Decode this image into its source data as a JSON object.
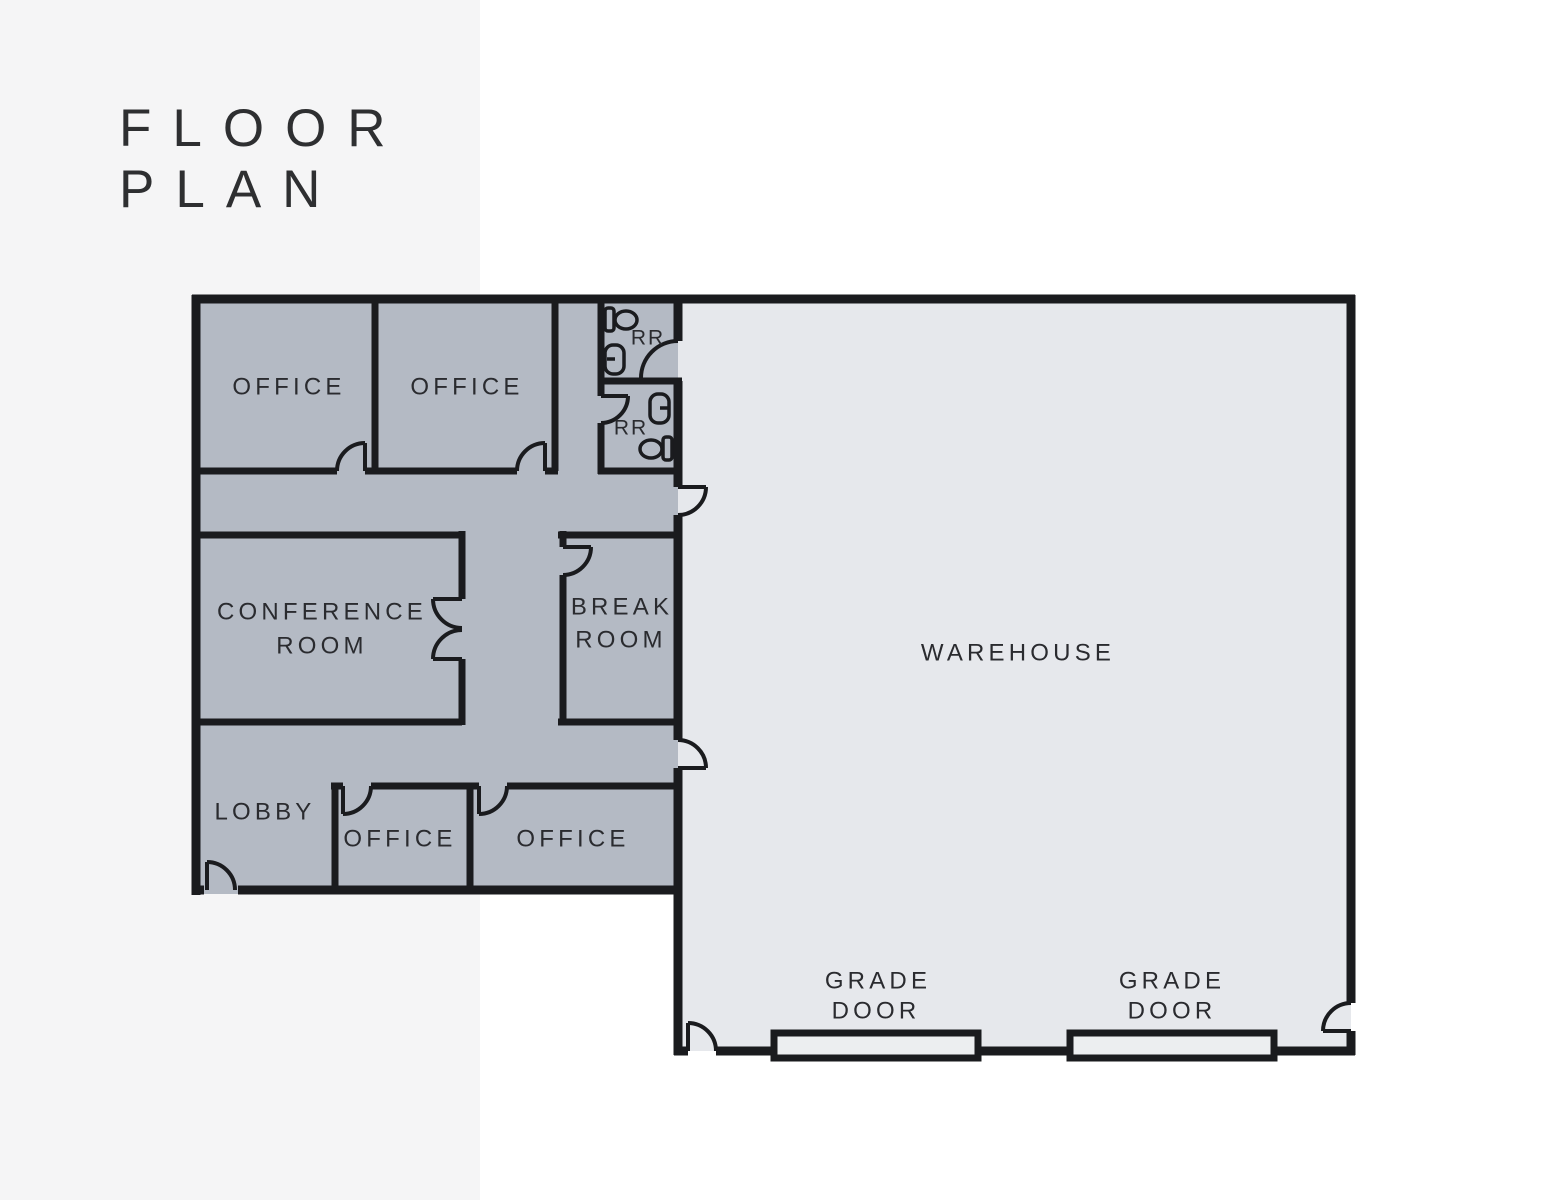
{
  "page": {
    "page_bg": "#ffffff",
    "panel_bg": "#f5f5f6",
    "title_color": "#2e2f31"
  },
  "title": {
    "line1": "FLOOR",
    "line2": "PLAN"
  },
  "plan": {
    "colors": {
      "wall": "#1a1b1e",
      "office_fill": "#b4bac4",
      "warehouse_fill": "#e6e8ec",
      "grade_fill": "#eceef0",
      "label_color": "#2a2b2f"
    },
    "labels": {
      "office_top_left": "OFFICE",
      "office_top_right": "OFFICE",
      "rr_upper": "RR",
      "rr_lower": "RR",
      "conference_line1": "CONFERENCE",
      "conference_line2": "ROOM",
      "break_line1": "BREAK",
      "break_line2": "ROOM",
      "lobby": "LOBBY",
      "office_bottom_left": "OFFICE",
      "office_bottom_right": "OFFICE",
      "warehouse": "WAREHOUSE",
      "grade_left_line1": "GRADE",
      "grade_left_line2": "DOOR",
      "grade_right_line1": "GRADE",
      "grade_right_line2": "DOOR"
    }
  }
}
